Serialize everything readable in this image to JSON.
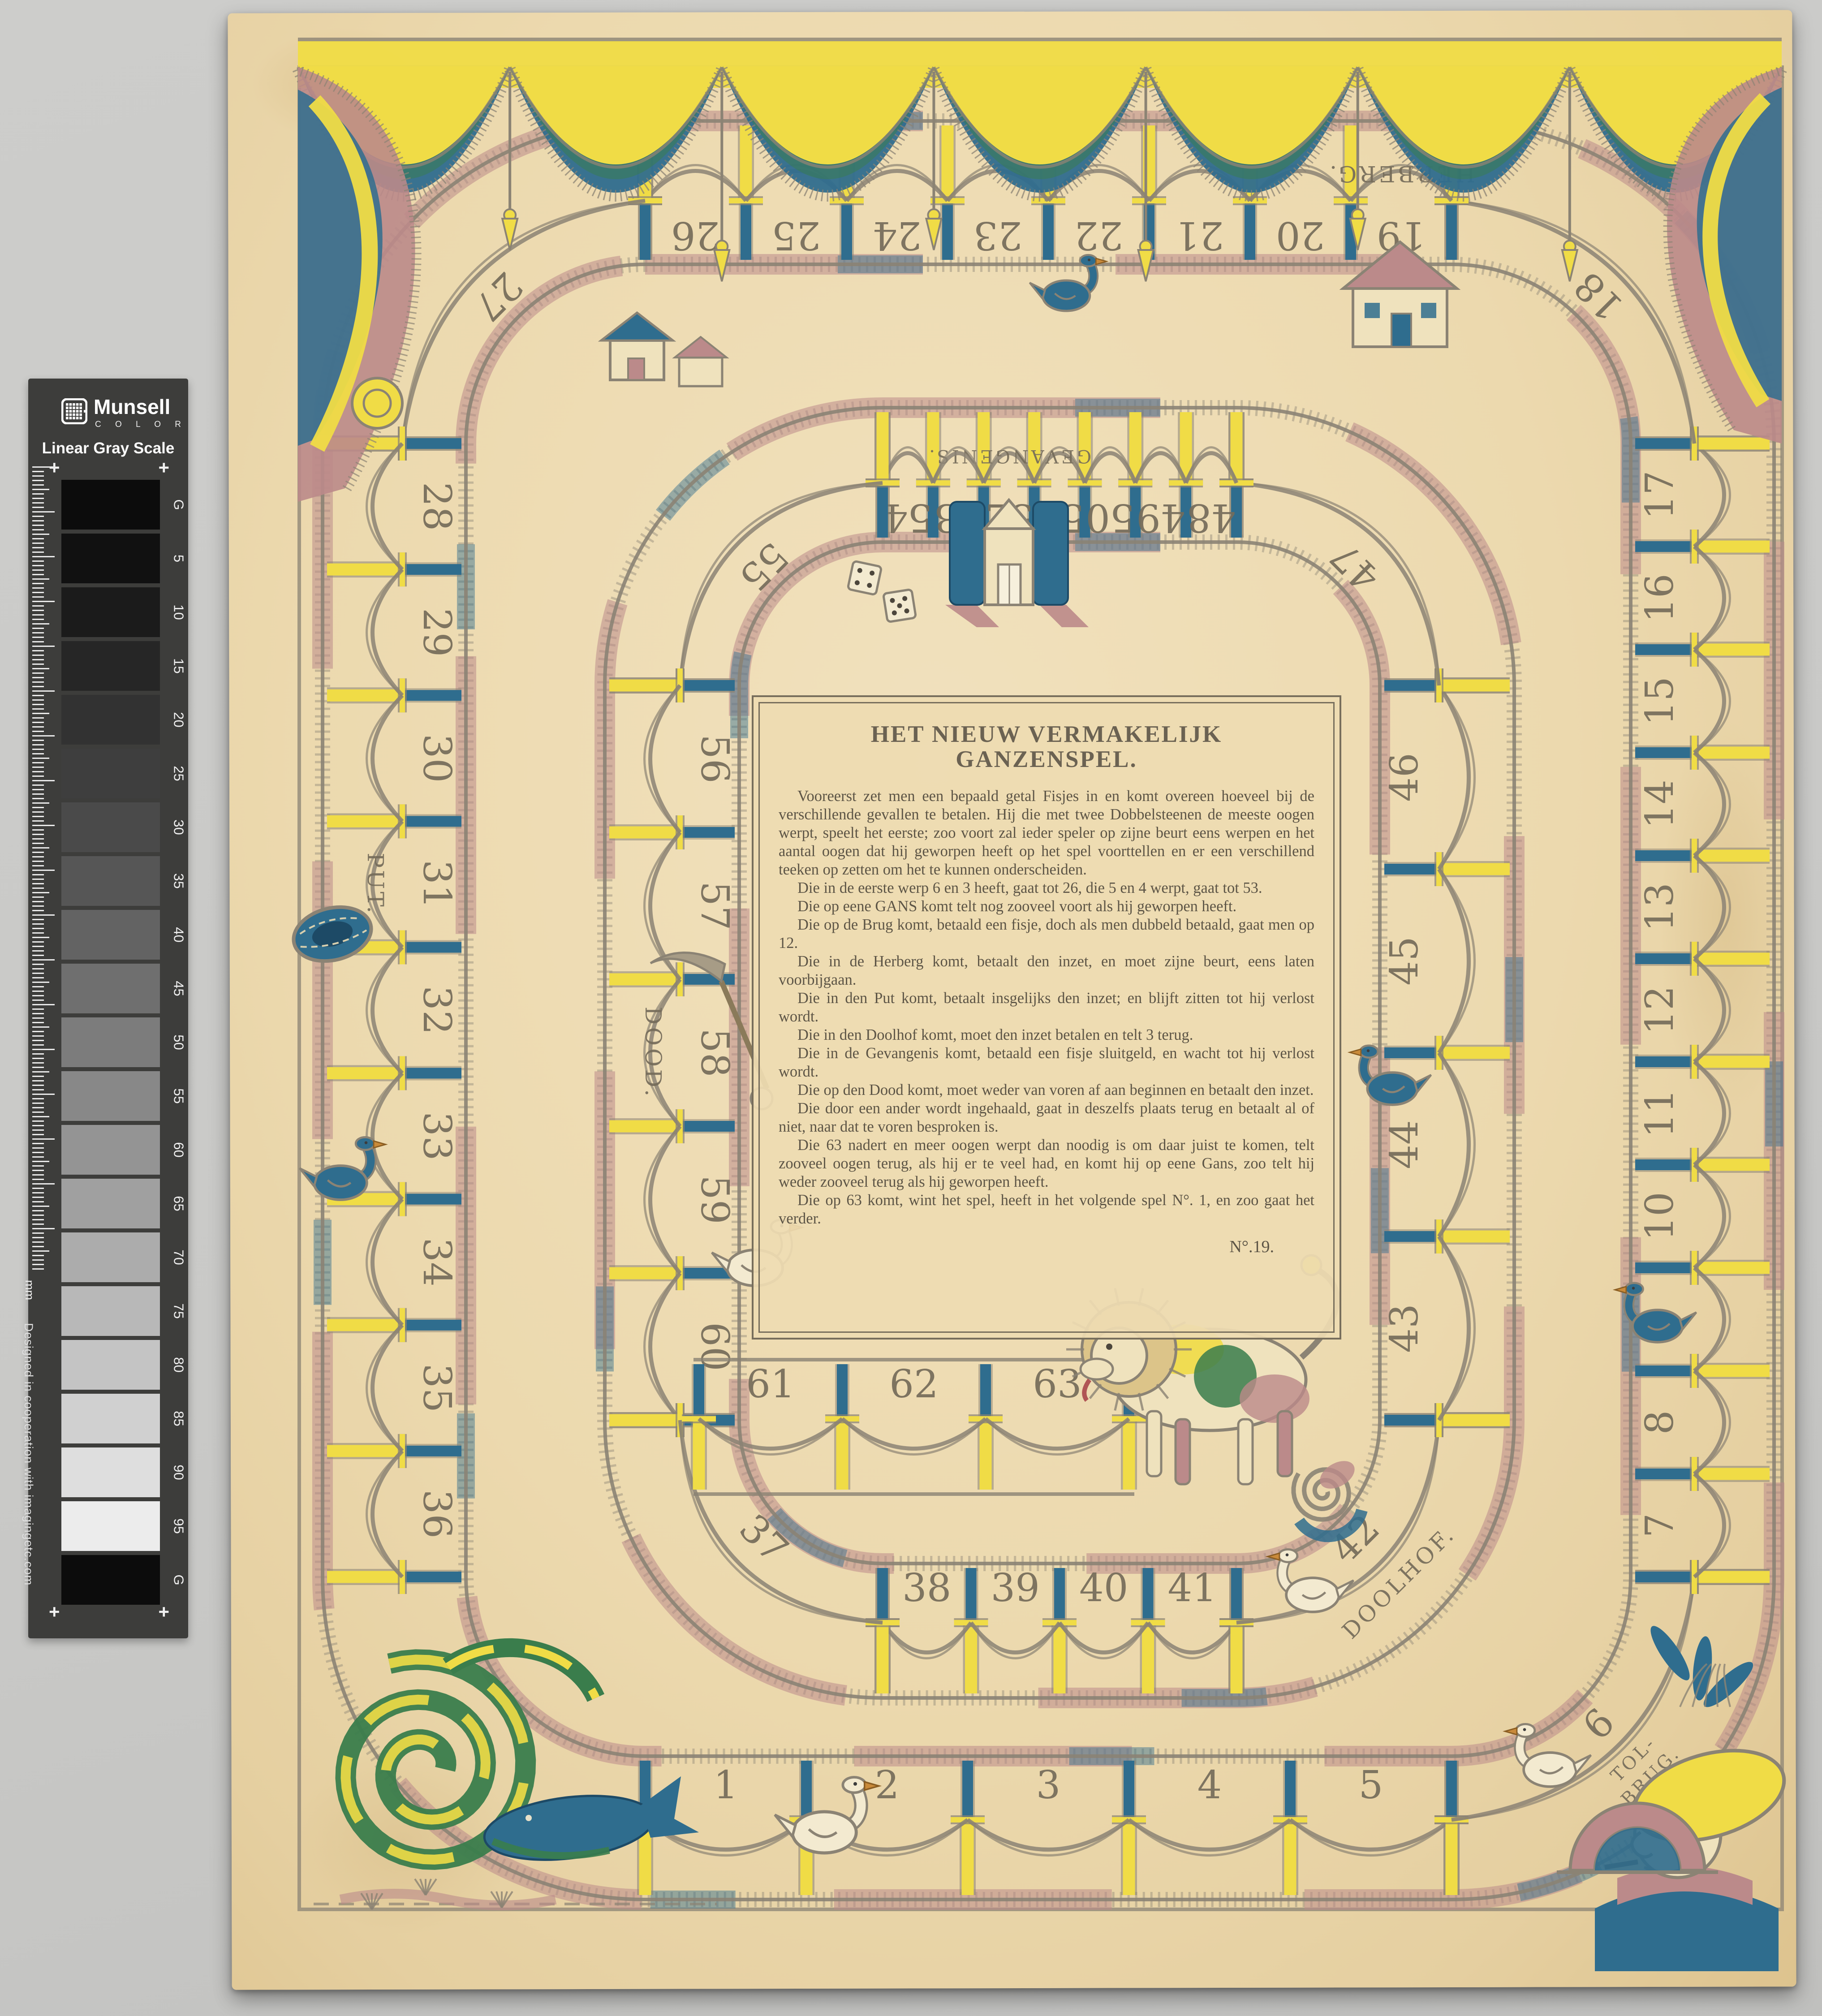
{
  "photo": {
    "background": "#c9c9c7"
  },
  "munsell_strip": {
    "brand": "Munsell",
    "brand_sub": "C O L O R",
    "title": "Linear Gray Scale",
    "plus_mark": "+",
    "ruler_unit": "mm",
    "credit": "Designed in cooperation with imagingetc.com",
    "panel_color": "#3d3d3b",
    "labels": [
      "G",
      "5",
      "10",
      "15",
      "20",
      "25",
      "30",
      "35",
      "40",
      "45",
      "50",
      "55",
      "60",
      "65",
      "70",
      "75",
      "80",
      "85",
      "90",
      "95",
      "G"
    ],
    "patch_colors": [
      "#0c0c0c",
      "#111111",
      "#1b1b1b",
      "#262626",
      "#323232",
      "#3e3e3e",
      "#4a4a4a",
      "#565656",
      "#636363",
      "#6f6f6f",
      "#7c7c7c",
      "#888888",
      "#949494",
      "#a0a0a0",
      "#acacac",
      "#b8b8b8",
      "#c4c4c4",
      "#d0d0d0",
      "#dedede",
      "#ececec",
      "#0c0c0c"
    ]
  },
  "board": {
    "title": "HET NIEUW VERMAKELIJK GANZENSPEL.",
    "paragraphs": [
      "Vooreerst zet men een bepaald getal Fisjes in en komt overeen hoeveel bij de verschillende gevallen te betalen. Hij die met twee Dobbelsteenen de meeste oogen werpt, speelt het eerste; zoo voort zal ieder speler op zijne beurt eens werpen en het aantal oogen dat hij geworpen heeft op het spel voorttellen en er een verschillend teeken op zetten om het te kunnen onderscheiden.",
      "Die in de eerste werp 6 en 3 heeft, gaat tot 26, die 5 en 4 werpt, gaat tot 53.",
      "Die op eene GANS komt telt nog zooveel voort als hij geworpen heeft.",
      "Die op de Brug komt, betaald een fisje, doch als men dubbeld betaald, gaat men op 12.",
      "Die in de Herberg komt, betaalt den inzet, en moet zijne beurt, eens laten voorbijgaan.",
      "Die in den Put komt, betaalt insgelijks den inzet; en blijft zitten tot hij verlost wordt.",
      "Die in den Doolhof komt, moet den inzet betalen en telt 3 terug.",
      "Die in de Gevangenis komt, betaald een fisje sluitgeld, en wacht tot hij verlost wordt.",
      "Die op den Dood komt, moet weder van voren af aan beginnen en betaalt den inzet.",
      "Die door een ander wordt ingehaald, gaat in deszelfs plaats terug en betaalt al of niet, naar dat te voren besproken is.",
      "Die 63 nadert en meer oogen werpt dan noodig is om daar juist te komen, telt zooveel oogen terug, als hij er te veel had, en komt hij op eene Gans, zoo telt hij weder zooveel terug als hij geworpen heeft.",
      "Die op 63 komt, wint het spel, heeft in het volgende spel N°. 1, en zoo gaat het verder."
    ],
    "signature": "N°.19.",
    "spaces": [
      1,
      2,
      3,
      4,
      5,
      6,
      7,
      8,
      9,
      10,
      11,
      12,
      13,
      14,
      15,
      16,
      17,
      18,
      19,
      20,
      21,
      22,
      23,
      24,
      25,
      26,
      27,
      28,
      29,
      30,
      31,
      32,
      33,
      34,
      35,
      36,
      37,
      38,
      39,
      40,
      41,
      42,
      43,
      44,
      45,
      46,
      47,
      48,
      49,
      50,
      51,
      52,
      53,
      54,
      55,
      56,
      57,
      58,
      59,
      60,
      61,
      62,
      63
    ],
    "special_spaces": {
      "6": "TOL-|BRUG.",
      "19": "HERBERG.",
      "31": "PUT.",
      "42": "DOOLHOF.",
      "52": "GEVANGENIS.",
      "58": "DOOD."
    },
    "palette": {
      "paper": "#ecd9ae",
      "yellow": "#f0dc46",
      "blue": "#2f6d8e",
      "pink": "#bb8a8a",
      "green": "#3a7d4c",
      "line": "#8b8374",
      "ink": "#756c5a"
    }
  }
}
